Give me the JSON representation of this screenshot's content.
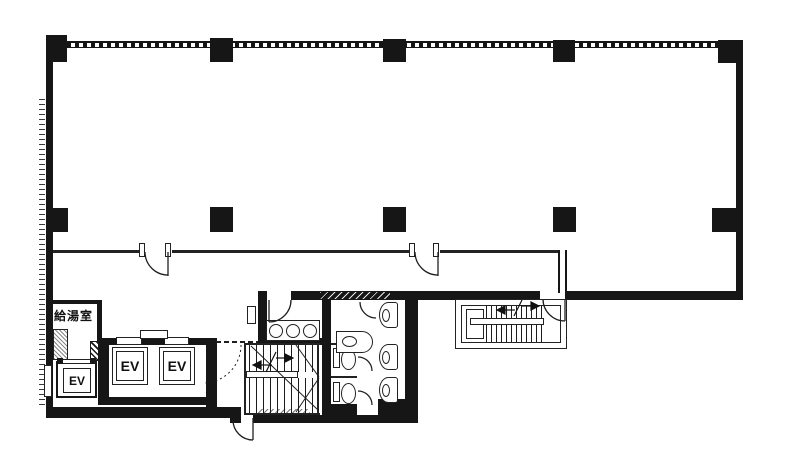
{
  "title": "Building floor plan",
  "colors": {
    "wall": "#161616",
    "line": "#222222",
    "background": "#ffffff"
  },
  "rooms": {
    "kitchenette": {
      "label": "給湯室"
    },
    "elevators": [
      {
        "label": "EV"
      },
      {
        "label": "EV"
      },
      {
        "label": "EV"
      }
    ]
  },
  "fixtures": {
    "columns": 10,
    "sinks": 3,
    "toilets": 2,
    "urinals": 3,
    "staircases": 2
  }
}
